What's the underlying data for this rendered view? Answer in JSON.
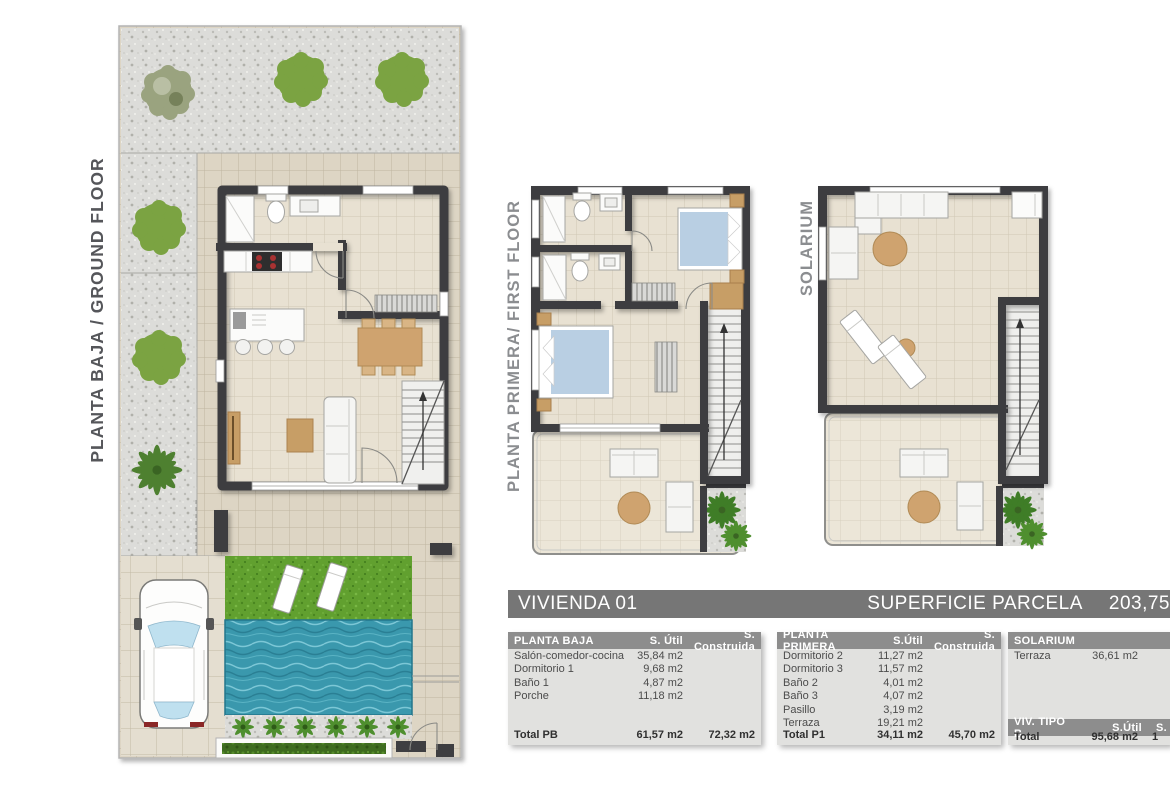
{
  "header_bar": {
    "title": "VIVIENDA 01",
    "right_label": "SUPERFICIE PARCELA",
    "right_value": "203,75"
  },
  "plans": {
    "ground": {
      "label": "PLANTA BAJA / GROUND FLOOR"
    },
    "first": {
      "label": "PLANTA PRIMERA/ FIRST FLOOR"
    },
    "solarium": {
      "label": "SOLARIUM"
    }
  },
  "tables": {
    "planta_baja": {
      "title": "PLANTA BAJA",
      "col_util": "S. Útil",
      "col_construida": "S. Construida",
      "rows": [
        {
          "label": "Salón-comedor-cocina",
          "util": "35,84 m2"
        },
        {
          "label": "Dormitorio 1",
          "util": "9,68 m2"
        },
        {
          "label": "Baño 1",
          "util": "4,87 m2"
        },
        {
          "label": "Porche",
          "util": "11,18 m2"
        }
      ],
      "total": {
        "label": "Total PB",
        "util": "61,57 m2",
        "construida": "72,32 m2"
      }
    },
    "planta_primera": {
      "title": "PLANTA PRIMERA",
      "col_util": "S.Útil",
      "col_construida": "S. Construida",
      "rows": [
        {
          "label": "Dormitorio 2",
          "util": "11,27 m2"
        },
        {
          "label": "Dormitorio 3",
          "util": "11,57 m2"
        },
        {
          "label": "Baño 2",
          "util": "4,01 m2"
        },
        {
          "label": "Baño 3",
          "util": "4,07 m2"
        },
        {
          "label": "Pasillo",
          "util": "3,19 m2"
        },
        {
          "label": "Terraza",
          "util": "19,21 m2"
        }
      ],
      "total": {
        "label": "Total P1",
        "util": "34,11 m2",
        "construida": "45,70 m2"
      }
    },
    "solarium": {
      "title": "SOLARIUM",
      "rows": [
        {
          "label": "Terraza",
          "util": "36,61 m2"
        }
      ]
    },
    "viv_tipo_b": {
      "title": "VIV. TIPO B",
      "col_util": "S.Útil",
      "col_construida": "S. C",
      "total": {
        "label": "Total",
        "util": "95,68 m2",
        "construida": "1"
      }
    }
  },
  "colors": {
    "wall": "#3e3e41",
    "floor": "#e8e1d2",
    "outdoor_tile": "#ddd5c4",
    "gravel": "#dcdcd9",
    "grass": "#61a02f",
    "pool_water": "#3a98ad",
    "bed_blue": "#b9cfe3",
    "wood_tan": "#cfa36f",
    "title_bar_gray": "#767676",
    "table_header_gray": "#8d8d8d",
    "table_body_gray": "#e1e1df"
  }
}
